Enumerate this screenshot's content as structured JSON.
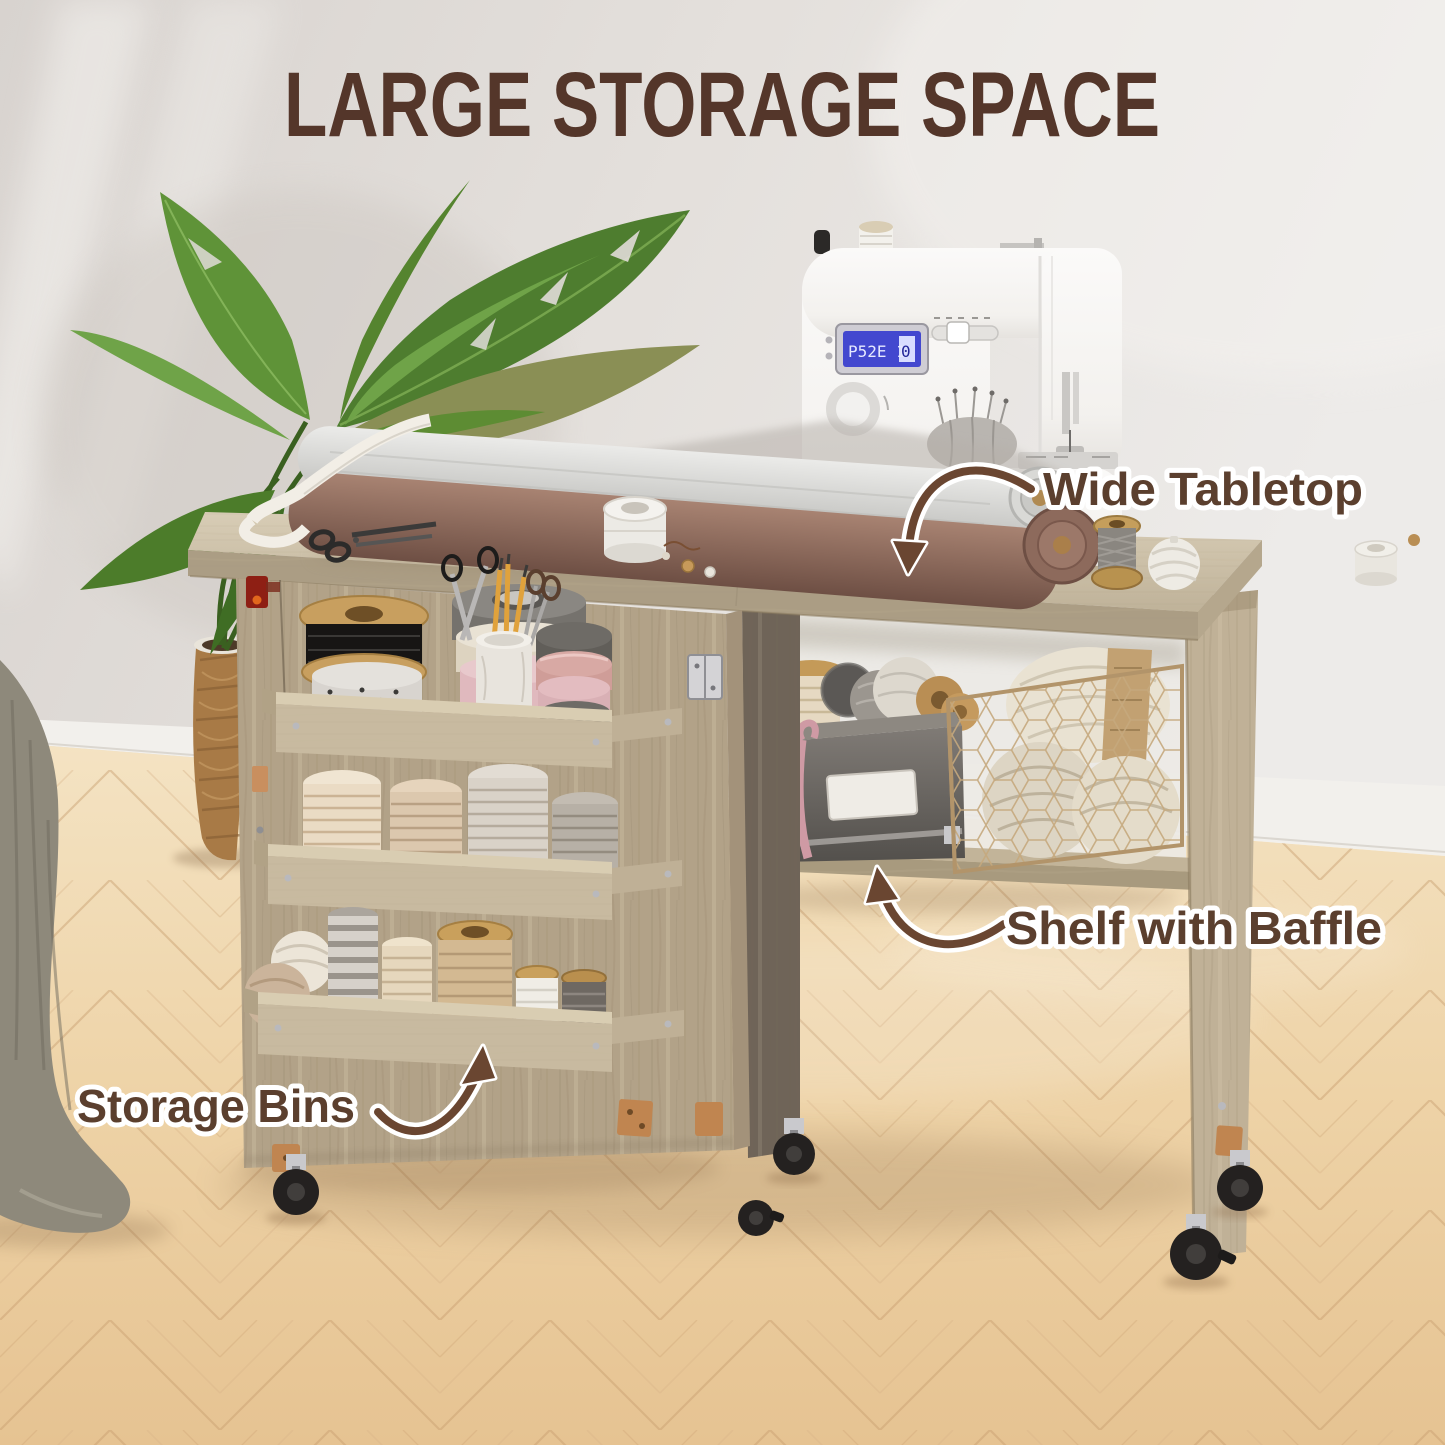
{
  "title": "LARGE STORAGE SPACE",
  "callouts": {
    "wide_tabletop": "Wide Tabletop",
    "shelf_with_baffle": "Shelf with Baffle",
    "storage_bins": "Storage Bins"
  },
  "sewing_machine": {
    "lcd_left": "P52E 1",
    "lcd_box": "0"
  },
  "colors": {
    "title_text": "#54362a",
    "callout_text": "#5b3f2e",
    "callout_outline": "#ffffff",
    "arrow": "#6a4631",
    "wall": "#e1dcd8",
    "baseboard": "#f2f0ec",
    "floor": "#ecd2a6",
    "cabinet_wood": "#b3a488",
    "tabletop_wood": "#cdc1a9",
    "machine_body": "#f6f5f3",
    "lcd_screen": "#4348cf",
    "caster": "#242120"
  }
}
